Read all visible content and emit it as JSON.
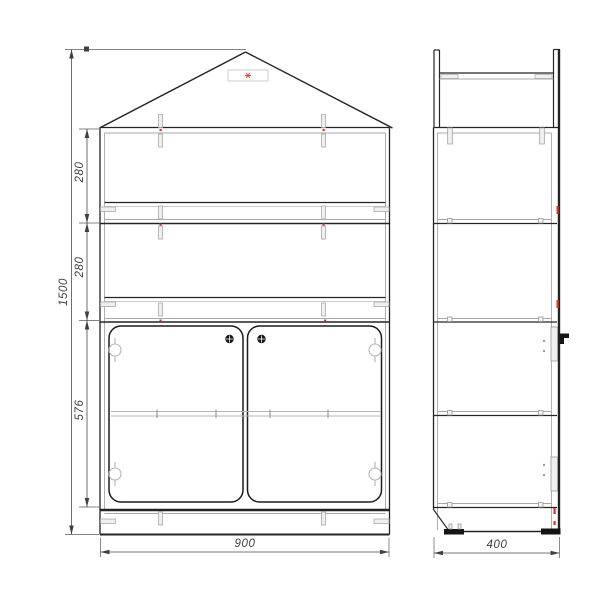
{
  "colors": {
    "background": "#ffffff",
    "primary_line": "#242424",
    "secondary_line": "#a8a8a8",
    "dimension_line": "#4a4a4a",
    "accent_red": "#cf3b2a"
  },
  "front_view": {
    "dimensions": {
      "total_height": "1500",
      "top_section_height": "280",
      "middle_section_height": "280",
      "door_section_height": "576",
      "overall_width": "900"
    }
  },
  "side_view": {
    "dimensions": {
      "overall_depth": "400"
    }
  }
}
